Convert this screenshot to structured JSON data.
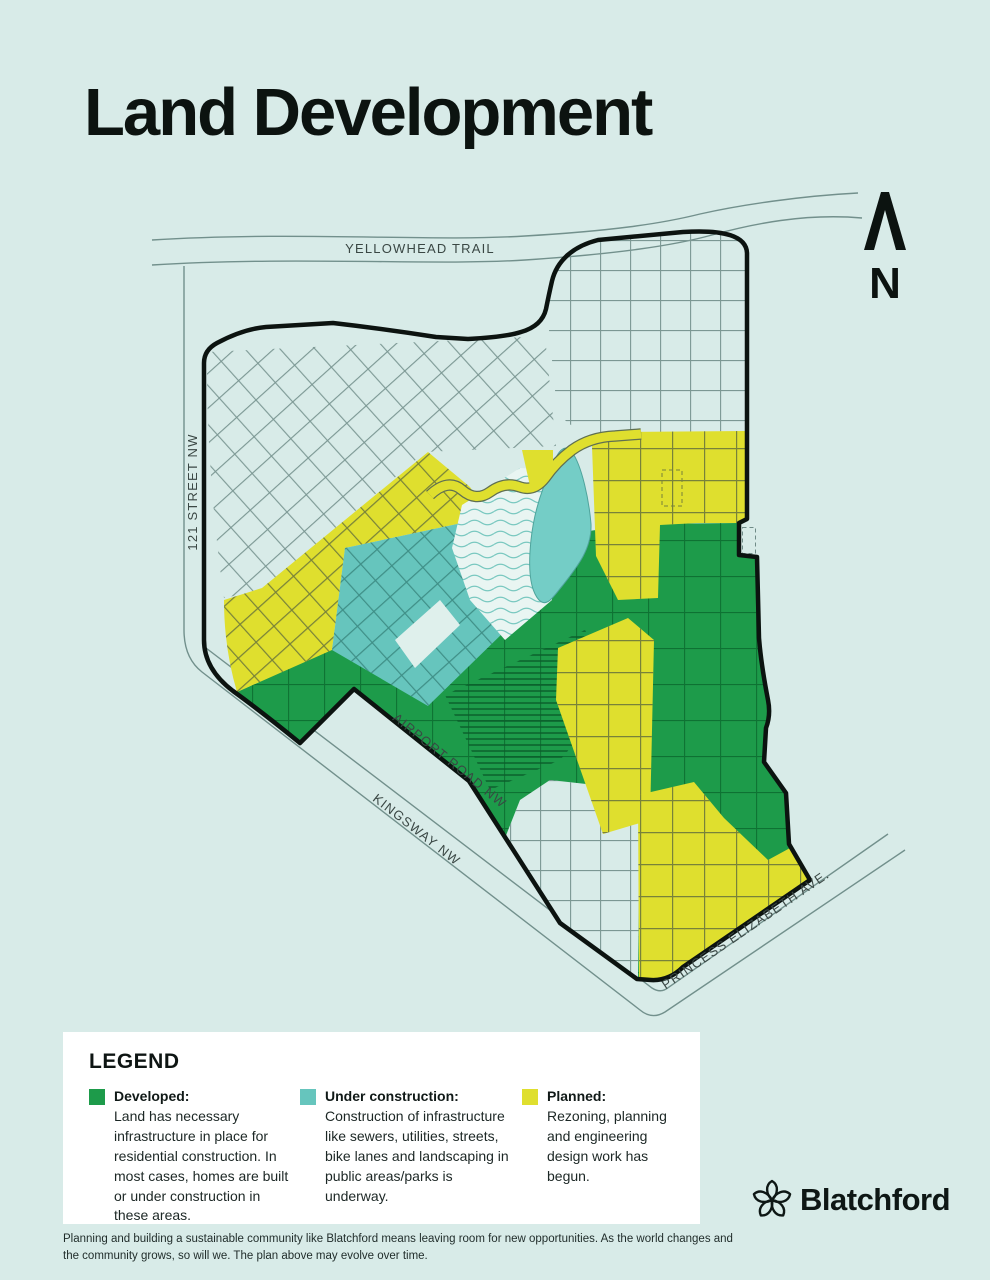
{
  "page": {
    "title": "Land Development",
    "background": "#d8ebe8"
  },
  "map": {
    "north_label": "N",
    "labels": {
      "yellowhead": "YELLOWHEAD TRAIL",
      "street121": "121 STREET NW",
      "airport": "AIRPORT ROAD NW",
      "kingsway": "KINGSWAY NW",
      "princess": "PRINCESS ELIZABETH AVE."
    },
    "colors": {
      "background": "#d8ebe8",
      "boundary": "#0c1310",
      "road": "#72908c",
      "developed": "#1d9b4a",
      "under_construction": "#66c5bd",
      "planned": "#dfdf2e",
      "lake": "#74cdc6",
      "park_wave": "#79c8c0"
    }
  },
  "legend": {
    "title": "LEGEND",
    "items": [
      {
        "label": "Developed:",
        "description": "Land has necessary infrastructure in place for residential construction. In most cases, homes are built or under construction in these areas.",
        "color": "#1d9b4a"
      },
      {
        "label": "Under construction:",
        "description": "Construction of infrastructure like sewers, utilities, streets, bike lanes and landscaping in public areas/parks is underway.",
        "color": "#66c5bd"
      },
      {
        "label": "Planned:",
        "description": "Rezoning, planning and engineering design work has begun.",
        "color": "#dfdf2e"
      }
    ]
  },
  "footer": {
    "text": "Planning and building a sustainable community like Blatchford means leaving room for new opportunities. As the world changes and the community grows, so will we. The plan above may evolve over time."
  },
  "brand": {
    "name": "Blatchford"
  }
}
